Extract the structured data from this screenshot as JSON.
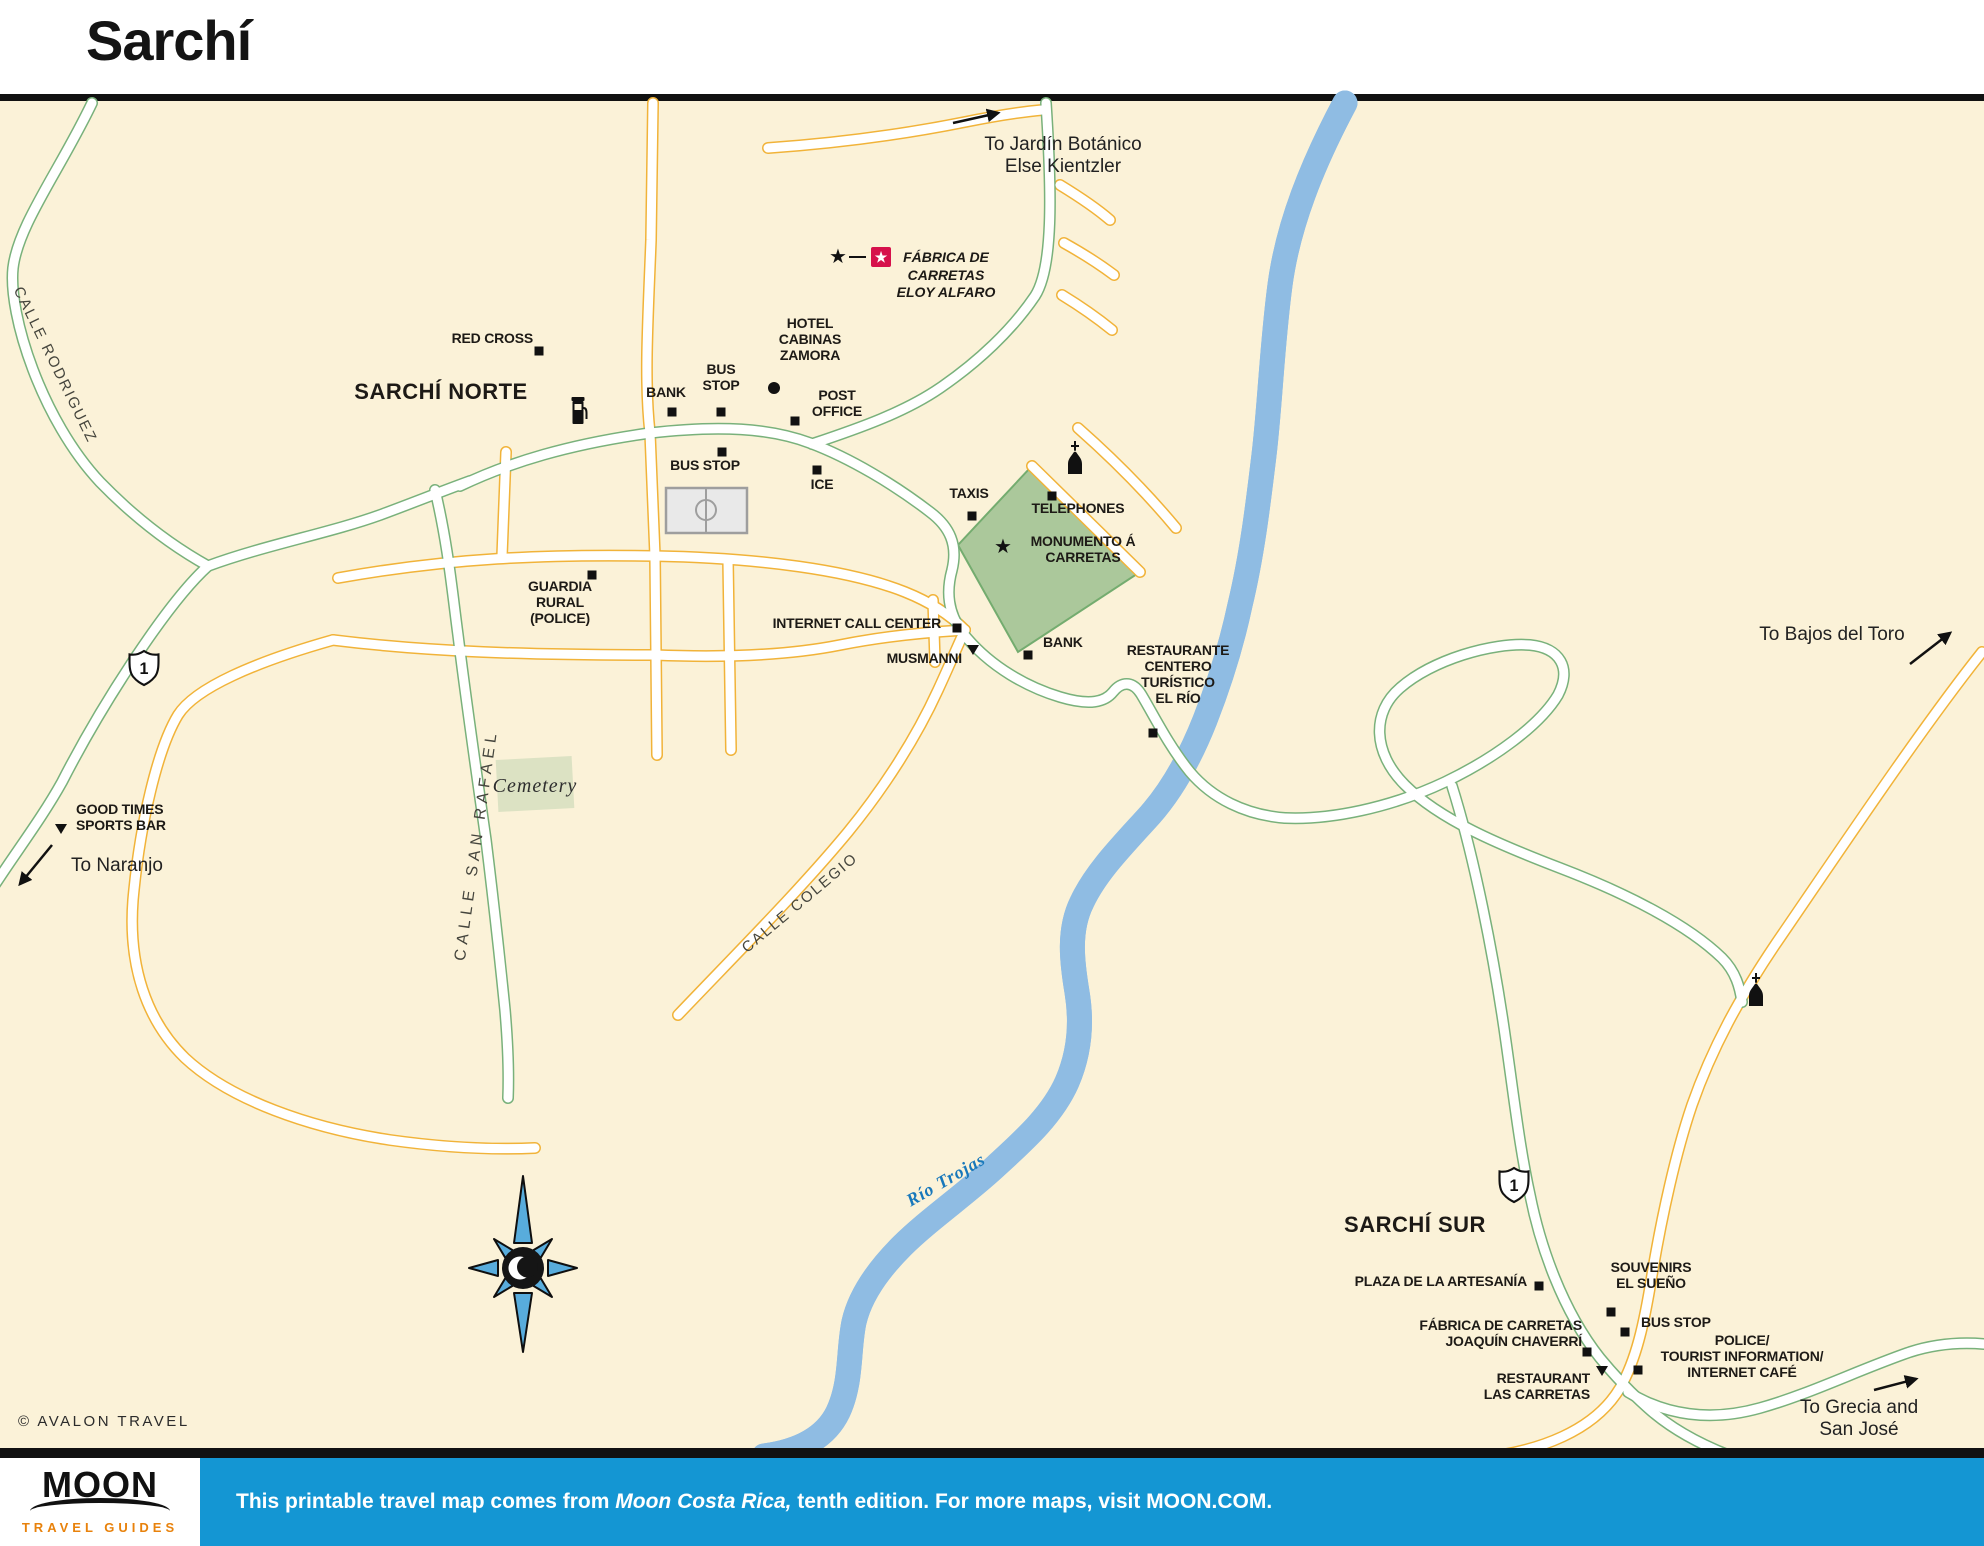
{
  "title": "Sarchí",
  "colors": {
    "map_background": "#FBF2D8",
    "road_casing_yellow": "#F1B339",
    "road_casing_green": "#79B17B",
    "river_blue": "#C9E2F5",
    "river_edge": "#8FBCE3",
    "plaza_green": "#ABC89B",
    "cemetery_green": "#DCE2C3",
    "sight_red": "#D6114B",
    "footer_blue": "#1496D3",
    "moon_orange": "#E8820C"
  },
  "map": {
    "scale_note": "SCALE NOT AVAILABLE",
    "labels": [
      {
        "id": "label-to-jardin",
        "text": "To Jardín Botánico\nElse Kientzler",
        "x": 1063,
        "y": 134,
        "cls": "to",
        "align": "center"
      },
      {
        "id": "label-fabrica-eloy-alfaro",
        "text": "FÁBRICA DE\nCARRETAS\nELOY ALFARO",
        "x": 946,
        "y": 249,
        "cls": "sight",
        "align": "center"
      },
      {
        "id": "label-red-cross",
        "text": "RED CROSS",
        "x": 533,
        "y": 331,
        "cls": "poi",
        "align": "right"
      },
      {
        "id": "label-sarchi-norte",
        "text": "SARCHÍ NORTE",
        "x": 441,
        "y": 379,
        "cls": "area",
        "align": "center"
      },
      {
        "id": "label-bank-1",
        "text": "BANK",
        "x": 666,
        "y": 385,
        "cls": "poi",
        "align": "center"
      },
      {
        "id": "label-bus-stop-1",
        "text": "BUS\nSTOP",
        "x": 721,
        "y": 362,
        "cls": "poi",
        "align": "center"
      },
      {
        "id": "label-hotel-cabinas-zamora",
        "text": "HOTEL\nCABINAS\nZAMORA",
        "x": 810,
        "y": 316,
        "cls": "poi",
        "align": "center"
      },
      {
        "id": "label-post-office",
        "text": "POST\nOFFICE",
        "x": 837,
        "y": 388,
        "cls": "poi",
        "align": "center"
      },
      {
        "id": "label-bus-stop-2",
        "text": "BUS STOP",
        "x": 705,
        "y": 458,
        "cls": "poi",
        "align": "center"
      },
      {
        "id": "label-ice",
        "text": "ICE",
        "x": 822,
        "y": 477,
        "cls": "poi",
        "align": "center"
      },
      {
        "id": "label-taxis",
        "text": "TAXIS",
        "x": 969,
        "y": 486,
        "cls": "poi",
        "align": "center"
      },
      {
        "id": "label-telephones",
        "text": "TELEPHONES",
        "x": 1078,
        "y": 501,
        "cls": "poi",
        "align": "center"
      },
      {
        "id": "label-monumento-a-carretas",
        "text": "MONUMENTO Á\nCARRETAS",
        "x": 1083,
        "y": 534,
        "cls": "poi",
        "align": "center"
      },
      {
        "id": "label-guardia-rural",
        "text": "GUARDIA\nRURAL\n(POLICE)",
        "x": 560,
        "y": 579,
        "cls": "poi",
        "align": "center"
      },
      {
        "id": "label-internet-call-center",
        "text": "INTERNET CALL CENTER",
        "x": 941,
        "y": 616,
        "cls": "poi",
        "align": "right"
      },
      {
        "id": "label-musmanni",
        "text": "MUSMANNI",
        "x": 962,
        "y": 651,
        "cls": "poi",
        "align": "right"
      },
      {
        "id": "label-bank-2",
        "text": "BANK",
        "x": 1043,
        "y": 635,
        "cls": "poi",
        "align": "left"
      },
      {
        "id": "label-restaurante-el-rio",
        "text": "RESTAURANTE\nCENTERO\nTURÍSTICO\nEL RÍO",
        "x": 1178,
        "y": 643,
        "cls": "poi",
        "align": "center"
      },
      {
        "id": "label-good-times-sports-bar",
        "text": "GOOD TIMES\nSPORTS BAR",
        "x": 76,
        "y": 802,
        "cls": "poi",
        "align": "left"
      },
      {
        "id": "label-to-naranjo",
        "text": "To Naranjo",
        "x": 117,
        "y": 855,
        "cls": "to",
        "align": "center"
      },
      {
        "id": "label-calle-rodriguez",
        "text": "CALLE RODRIGUEZ",
        "x": 55,
        "y": 365,
        "cls": "street",
        "align": "center",
        "rot": 64
      },
      {
        "id": "label-calle-san-rafael",
        "text": "CALLE SAN RAFAEL",
        "x": 477,
        "y": 845,
        "cls": "street-wide",
        "align": "center",
        "rot": -82
      },
      {
        "id": "label-cemetery",
        "text": "Cemetery",
        "x": 535,
        "y": 775,
        "cls": "cemetery",
        "align": "center"
      },
      {
        "id": "label-to-bajos-del-toro",
        "text": "To Bajos del Toro",
        "x": 1832,
        "y": 624,
        "cls": "to",
        "align": "center"
      },
      {
        "id": "label-calle-colegio",
        "text": "CALLE COLEGIO",
        "x": 800,
        "y": 903,
        "cls": "street",
        "align": "center",
        "rot": -40
      },
      {
        "id": "label-rio-trojas",
        "text": "Río Trojas",
        "x": 946,
        "y": 1180,
        "cls": "river",
        "align": "center",
        "rot": -30
      },
      {
        "id": "label-sarchi-sur",
        "text": "SARCHÍ SUR",
        "x": 1415,
        "y": 1212,
        "cls": "area",
        "align": "center"
      },
      {
        "id": "label-plaza-de-la-artesania",
        "text": "PLAZA DE LA ARTESANÍA",
        "x": 1527,
        "y": 1274,
        "cls": "poi",
        "align": "right"
      },
      {
        "id": "label-souvenirs-el-sueno",
        "text": "SOUVENIRS\nEL SUEÑO",
        "x": 1651,
        "y": 1260,
        "cls": "poi",
        "align": "center"
      },
      {
        "id": "label-bus-stop-3",
        "text": "BUS STOP",
        "x": 1641,
        "y": 1315,
        "cls": "poi",
        "align": "left"
      },
      {
        "id": "label-fabrica-joaquin-chaverri",
        "text": "FÁBRICA DE CARRETAS\nJOAQUÍN CHAVERRÍ",
        "x": 1582,
        "y": 1318,
        "cls": "poi",
        "align": "right"
      },
      {
        "id": "label-restaurant-las-carretas",
        "text": "RESTAURANT\nLAS CARRETAS",
        "x": 1590,
        "y": 1371,
        "cls": "poi",
        "align": "right"
      },
      {
        "id": "label-police-tourist-info",
        "text": "POLICE/\nTOURIST INFORMATION/\nINTERNET CAFÉ",
        "x": 1742,
        "y": 1333,
        "cls": "poi",
        "align": "center"
      },
      {
        "id": "label-to-grecia-san-jose",
        "text": "To Grecia and\nSan José",
        "x": 1859,
        "y": 1397,
        "cls": "to",
        "align": "center"
      },
      {
        "id": "label-copyright",
        "text": "© AVALON TRAVEL",
        "x": 18,
        "y": 1413,
        "cls": "copyright",
        "align": "left"
      }
    ],
    "markers": [
      {
        "id": "red-cross-marker",
        "type": "square",
        "x": 539,
        "y": 351
      },
      {
        "id": "gas-station-icon",
        "type": "gas",
        "x": 580,
        "y": 411
      },
      {
        "id": "bank-1-marker",
        "type": "square",
        "x": 672,
        "y": 412
      },
      {
        "id": "bus-stop-1-marker",
        "type": "square",
        "x": 721,
        "y": 412
      },
      {
        "id": "hotel-cabinas-zamora-marker",
        "type": "circle",
        "x": 774,
        "y": 388
      },
      {
        "id": "post-office-marker",
        "type": "square",
        "x": 795,
        "y": 421
      },
      {
        "id": "bus-stop-2-marker",
        "type": "square",
        "x": 722,
        "y": 452
      },
      {
        "id": "ice-marker",
        "type": "square",
        "x": 817,
        "y": 470
      },
      {
        "id": "taxis-marker",
        "type": "square",
        "x": 972,
        "y": 516
      },
      {
        "id": "telephones-marker",
        "type": "square",
        "x": 1052,
        "y": 496
      },
      {
        "id": "monumento-star",
        "type": "star",
        "x": 1003,
        "y": 547
      },
      {
        "id": "church-icon-1",
        "type": "church",
        "x": 1075,
        "y": 458
      },
      {
        "id": "guardia-rural-marker",
        "type": "square",
        "x": 592,
        "y": 575
      },
      {
        "id": "internet-call-center-marker",
        "type": "square",
        "x": 957,
        "y": 628
      },
      {
        "id": "musmanni-marker",
        "type": "triangle",
        "x": 973,
        "y": 650
      },
      {
        "id": "bank-2-marker",
        "type": "square",
        "x": 1028,
        "y": 655
      },
      {
        "id": "restaurante-el-rio-marker",
        "type": "square",
        "x": 1153,
        "y": 733
      },
      {
        "id": "good-times-marker",
        "type": "triangle",
        "x": 61,
        "y": 829
      },
      {
        "id": "highway-shield-1-north",
        "type": "shield",
        "x": 144,
        "y": 668,
        "text": "1"
      },
      {
        "id": "fabrica-eloy-star",
        "type": "star",
        "x": 838,
        "y": 257
      },
      {
        "id": "fabrica-eloy-sight-box",
        "type": "sight",
        "x": 881,
        "y": 257,
        "text": "★"
      },
      {
        "id": "church-icon-2",
        "type": "church",
        "x": 1756,
        "y": 990
      },
      {
        "id": "highway-shield-1-south",
        "type": "shield",
        "x": 1514,
        "y": 1185,
        "text": "1"
      },
      {
        "id": "plaza-artesania-marker",
        "type": "square",
        "x": 1539,
        "y": 1286
      },
      {
        "id": "souvenirs-marker",
        "type": "square",
        "x": 1611,
        "y": 1312
      },
      {
        "id": "bus-stop-3-marker",
        "type": "square",
        "x": 1625,
        "y": 1332
      },
      {
        "id": "fabrica-joaquin-marker",
        "type": "square",
        "x": 1587,
        "y": 1352
      },
      {
        "id": "las-carretas-marker",
        "type": "triangle",
        "x": 1602,
        "y": 1371
      },
      {
        "id": "police-tourist-marker",
        "type": "square",
        "x": 1638,
        "y": 1370
      }
    ]
  },
  "footer": {
    "logo_title": "MOON",
    "logo_subtitle": "TRAVEL GUIDES",
    "text_prefix": "This printable travel map comes from ",
    "text_italic": "Moon Costa Rica,",
    "text_suffix": " tenth edition. For more maps, visit MOON.COM."
  }
}
